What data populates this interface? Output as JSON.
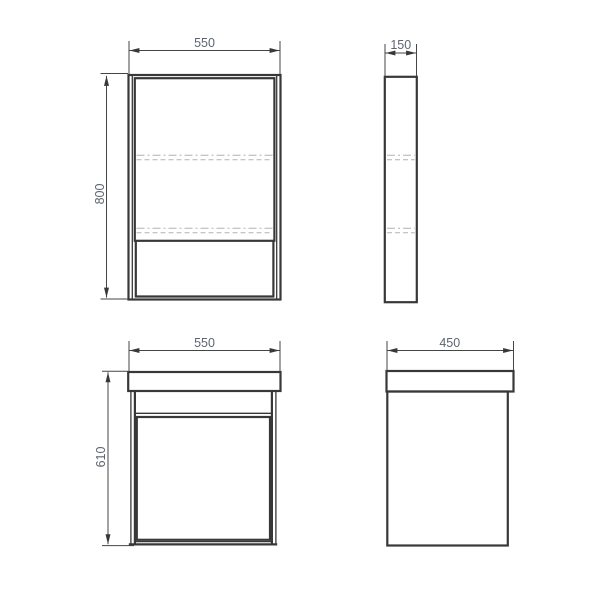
{
  "drawing": {
    "background_color": "#ffffff",
    "line_color": "#383838",
    "hidden_line_color": "#b2b2b2",
    "dim_line_color": "#454545",
    "dim_text_color": "#5d6470",
    "views": [
      {
        "id": "cabinet-front",
        "dimensions": {
          "width": "550",
          "height": "800"
        }
      },
      {
        "id": "cabinet-side",
        "dimensions": {
          "depth": "150"
        }
      },
      {
        "id": "vanity-front",
        "dimensions": {
          "width": "550",
          "height": "610"
        }
      },
      {
        "id": "vanity-side",
        "dimensions": {
          "depth": "450"
        }
      }
    ]
  }
}
